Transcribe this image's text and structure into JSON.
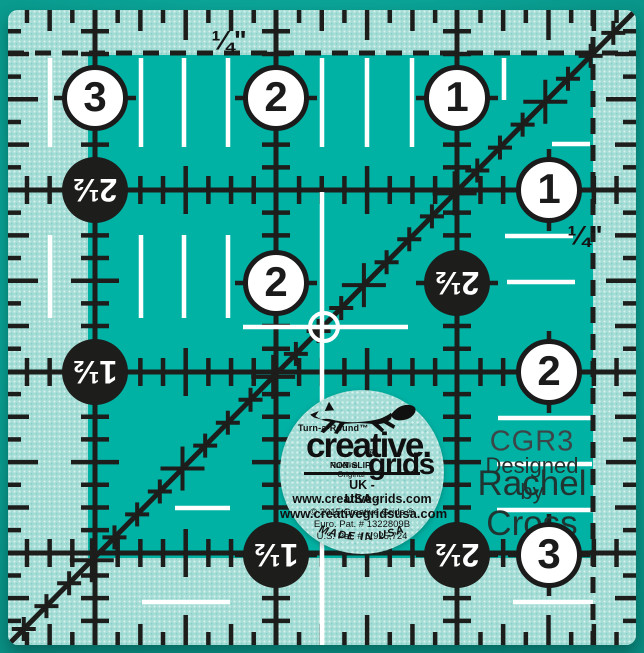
{
  "product": {
    "model": "CGR3",
    "designed_by_label": "Designed by",
    "designer": "Rachel Cross"
  },
  "ruler": {
    "quarter_label_top": "¼\"",
    "quarter_label_right": "¼\"",
    "white_circles": [
      {
        "value": "3",
        "x": 87,
        "y": 88
      },
      {
        "value": "2",
        "x": 268,
        "y": 88
      },
      {
        "value": "1",
        "x": 449,
        "y": 88
      },
      {
        "value": "1",
        "x": 541,
        "y": 180
      },
      {
        "value": "2",
        "x": 268,
        "y": 273
      },
      {
        "value": "2",
        "x": 541,
        "y": 362
      },
      {
        "value": "3",
        "x": 541,
        "y": 545
      }
    ],
    "black_circles": [
      {
        "value": "2½",
        "x": 87,
        "y": 180
      },
      {
        "value": "2½",
        "x": 449,
        "y": 273
      },
      {
        "value": "1½",
        "x": 87,
        "y": 362
      },
      {
        "value": "1½",
        "x": 268,
        "y": 545
      },
      {
        "value": "2½",
        "x": 449,
        "y": 545
      }
    ]
  },
  "logo": {
    "turn_a_round": "Turn-a-Round™",
    "brand_line1": "creative.",
    "brand_line2": "grids",
    "registered": "®",
    "tagline_prefix": "The Original ",
    "tagline_bold": "NON-SLIP",
    "tagline_suffix": " Ruler",
    "uk_line": "UK - www.creativegrids.com",
    "usa_line": "USA - www.creativegridsusa.com",
    "copyright_line": "© 2015  Creative Grids ®",
    "euro_patent": "Euro. Pat. # 1322809B",
    "us_patent": "U.S. Pat. # 6,925,724",
    "made_in": "MADE IN USA"
  },
  "colors": {
    "teal": "#00b2a4",
    "frost": "#a5ddd6",
    "ink": "#1d1d1b",
    "white": "#ffffff",
    "text_dark": "#203432",
    "model_gray": "#3c4547"
  }
}
